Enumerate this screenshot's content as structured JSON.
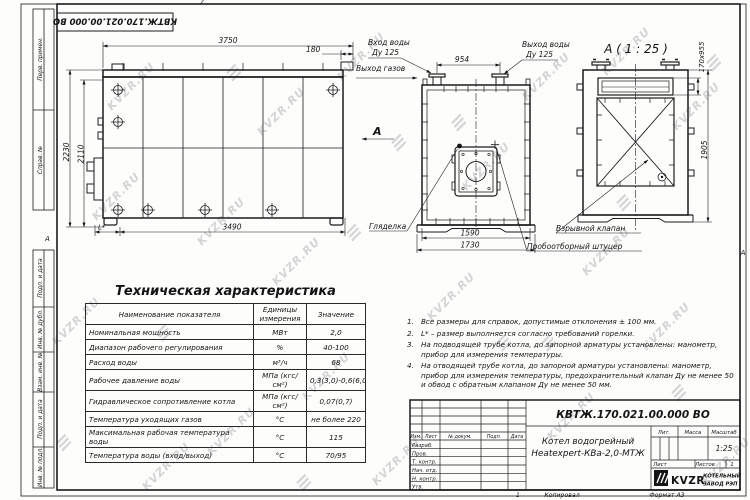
{
  "watermark": {
    "text": "KVZR.RU",
    "glyph": "≡"
  },
  "frame": {
    "top_doc_number": "КВТЖ.170.021.00.000 ВО",
    "zone_left": "А",
    "zone_right": "А",
    "zone_top": "2",
    "zone_bottom": "1",
    "strips": [
      "Перв. примен.",
      "Справ. №",
      "Подп. и дата",
      "Инв. № дубл.",
      "Взам. инв. №",
      "Подп. и дата",
      "Инв. № подл."
    ]
  },
  "drawing": {
    "side": {
      "dim_width": "3750",
      "dim_offset": "180",
      "dim_h1": "2230",
      "dim_h2": "2110",
      "dim_bottom": "3490",
      "dim_l": "L*"
    },
    "front": {
      "label_in": "Вход воды",
      "label_in_dn": "Ду 125",
      "label_out": "Выход воды",
      "label_out_dn": "Ду 125",
      "label_gas": "Выход газов",
      "view_mark": "А",
      "dim_nozzles": "954",
      "dim_body": "1590",
      "dim_base": "1730",
      "label_sight": "Гляделка",
      "label_sample": "Пробоотборный штуцер"
    },
    "section": {
      "title": "А ( 1 : 25 )",
      "label_valve": "Взрывной клапан",
      "dim_slot": "170х955",
      "dim_height": "1905"
    }
  },
  "spec_table": {
    "title": "Техническая характеристика",
    "headers": [
      "Наименование показателя",
      "Единицы измерения",
      "Значение"
    ],
    "rows": [
      {
        "name": "Номинальная мощность",
        "unit": "МВт",
        "value": "2,0"
      },
      {
        "name": "Диапазон рабочего регулирования",
        "unit": "%",
        "value": "40-100"
      },
      {
        "name": "Расход воды",
        "unit": "м³/ч",
        "value": "68"
      },
      {
        "name": "Рабочее давление воды",
        "unit": "МПа (кгс/см²)",
        "value": "0,3(3,0)-0,6(6,0)"
      },
      {
        "name": "Гидравлическое сопротивление котла",
        "unit": "МПа (кгс/см²)",
        "value": "0,07(0,7)"
      },
      {
        "name": "Температура уходящих газов",
        "unit": "°С",
        "value": "не более 220"
      },
      {
        "name": "Максимальная рабочая температура воды",
        "unit": "°С",
        "value": "115"
      },
      {
        "name": "Температура воды (вход/выход)",
        "unit": "°С",
        "value": "70/95"
      }
    ]
  },
  "notes": [
    {
      "num": "1.",
      "text": "Все размеры для справок, допустимые отклонения ± 100 мм."
    },
    {
      "num": "2.",
      "text": "L* – размер выполняется согласно требований горелки."
    },
    {
      "num": "3.",
      "text": "На подводящей трубе котла, до запорной арматуры установлены: манометр, прибор для измерения температуры."
    },
    {
      "num": "4.",
      "text": "На отводящей трубе котла, до запорной арматуры установлены: манометр, прибор для измерения температуры, предохранительный клапан Ду не менее 50 и обвод с обратным клапаном Ду не менее 50 мм."
    }
  ],
  "title_block": {
    "doc_number": "КВТЖ.170.021.00.000 ВО",
    "name_line1": "Котел водогрейный",
    "name_line2": "Heatexpert-КВа-2,0-МТЖ",
    "lit_label": "Лит.",
    "mass_label": "Масса",
    "scale_label": "Масштаб",
    "scale_value": "1:25",
    "sheet_label": "Лист",
    "sheets_label": "Листов",
    "sheets_value": "1",
    "cols": [
      "Изм.",
      "Лист",
      "№ докум.",
      "Подп.",
      "Дата"
    ],
    "rows": [
      "Разраб.",
      "Пров.",
      "Т. контр.",
      "Нач. отд.",
      "Н. контр.",
      "Утв."
    ],
    "logo_text": "KVZR",
    "company_line1": "КОТЕЛЬНЫЙ",
    "company_line2": "ЗАВОД РЭП",
    "copied_label": "Копировал",
    "format_label": "Формат А3"
  }
}
